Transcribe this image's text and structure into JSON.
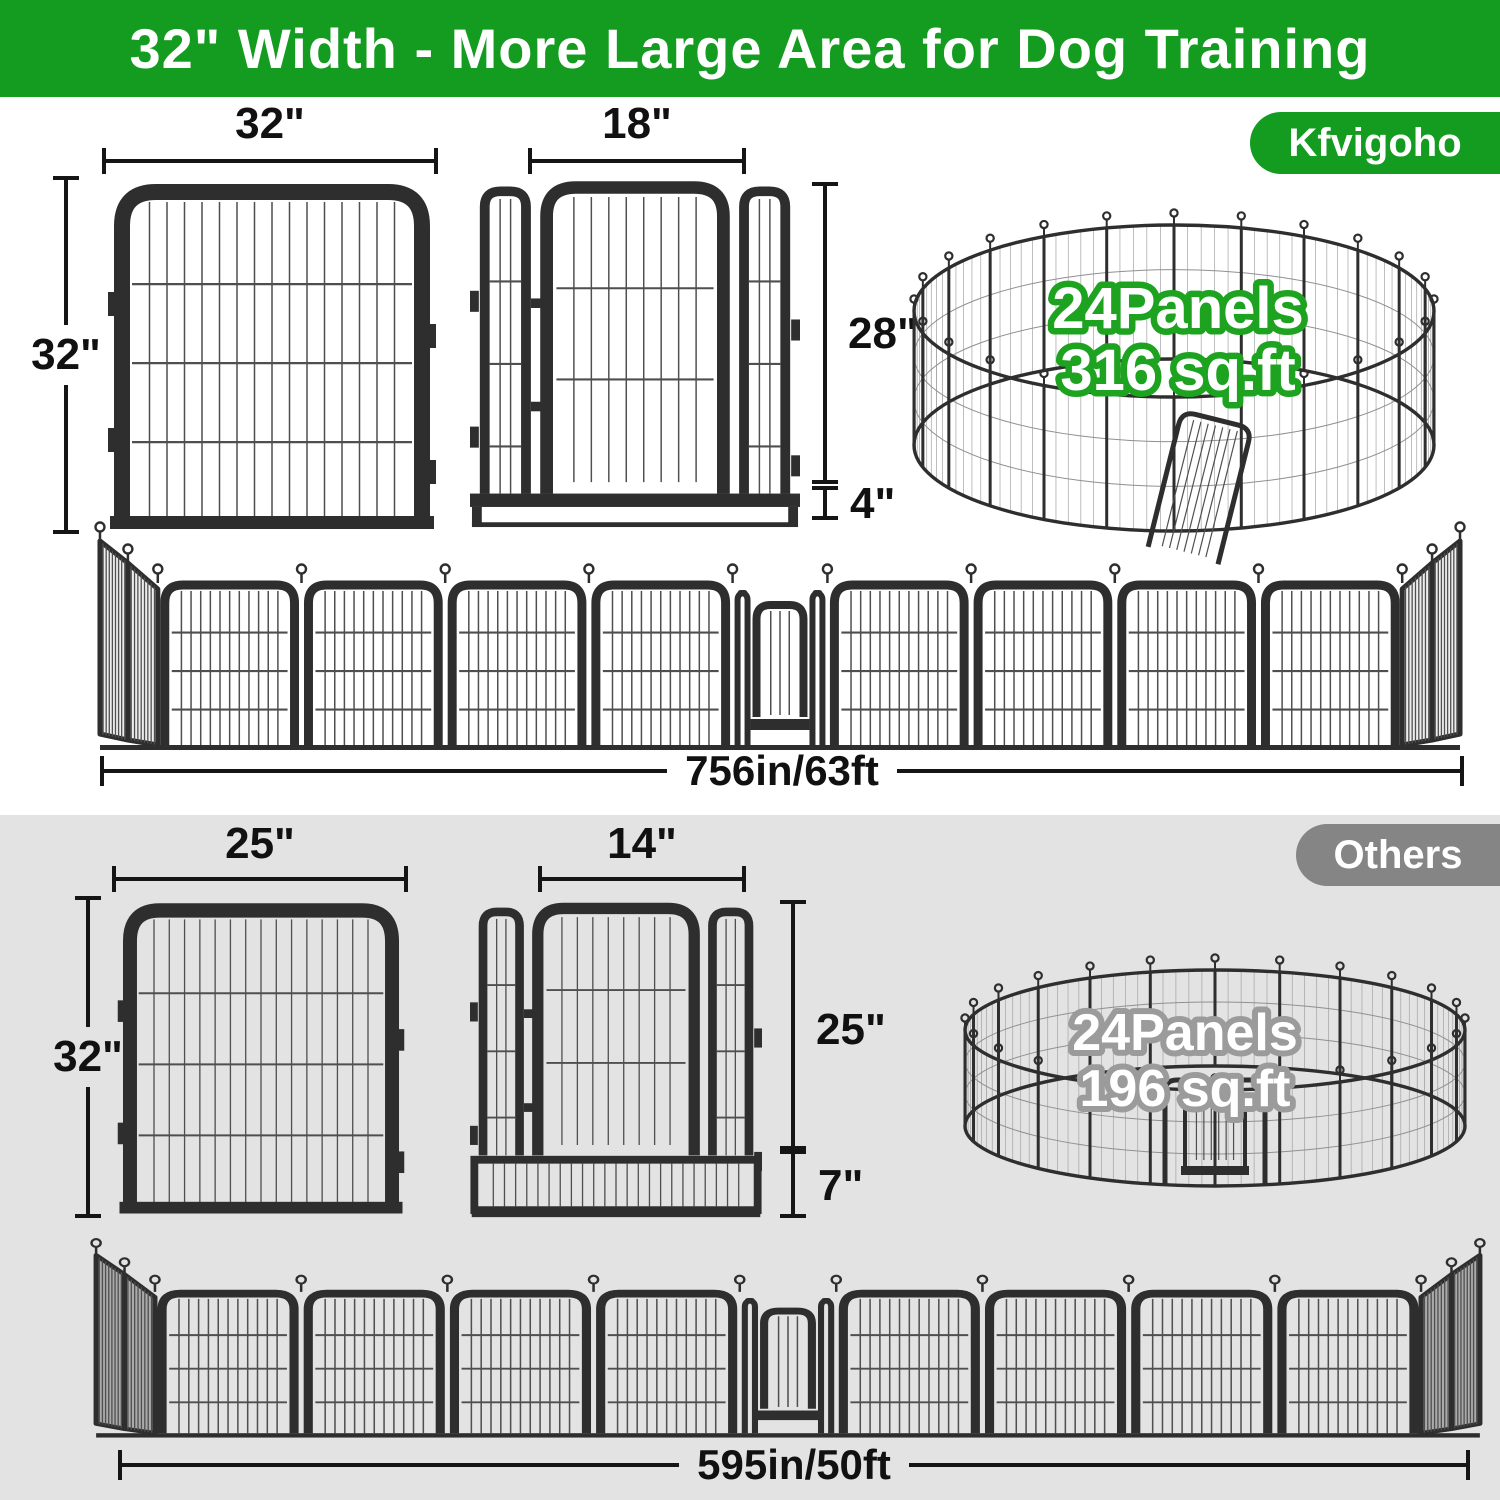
{
  "banner": {
    "title": "32\" Width - More Large Area for Dog Training"
  },
  "brand": {
    "name": "Kfvigoho"
  },
  "others_label": "Others",
  "kfvigoho": {
    "panel_width": "32\"",
    "panel_height": "32\"",
    "door_width": "18\"",
    "door_height": "28\"",
    "door_bottom_height": "4\"",
    "pen_panels": "24Panels",
    "pen_area": "316 sq.ft",
    "row_length": "756in/63ft"
  },
  "others": {
    "panel_width": "25\"",
    "panel_height": "32\"",
    "door_width": "14\"",
    "door_height": "25\"",
    "door_bottom_height": "7\"",
    "pen_panels": "24Panels",
    "pen_area": "196 sq.ft",
    "row_length": "595in/50ft"
  },
  "colors": {
    "brand_green": "#149c20",
    "pen_text_stroke_green": "#1ea321",
    "others_pill_gray": "#858585",
    "others_section_gray": "#e3e3e3",
    "frame_black": "#2e2e2e"
  }
}
